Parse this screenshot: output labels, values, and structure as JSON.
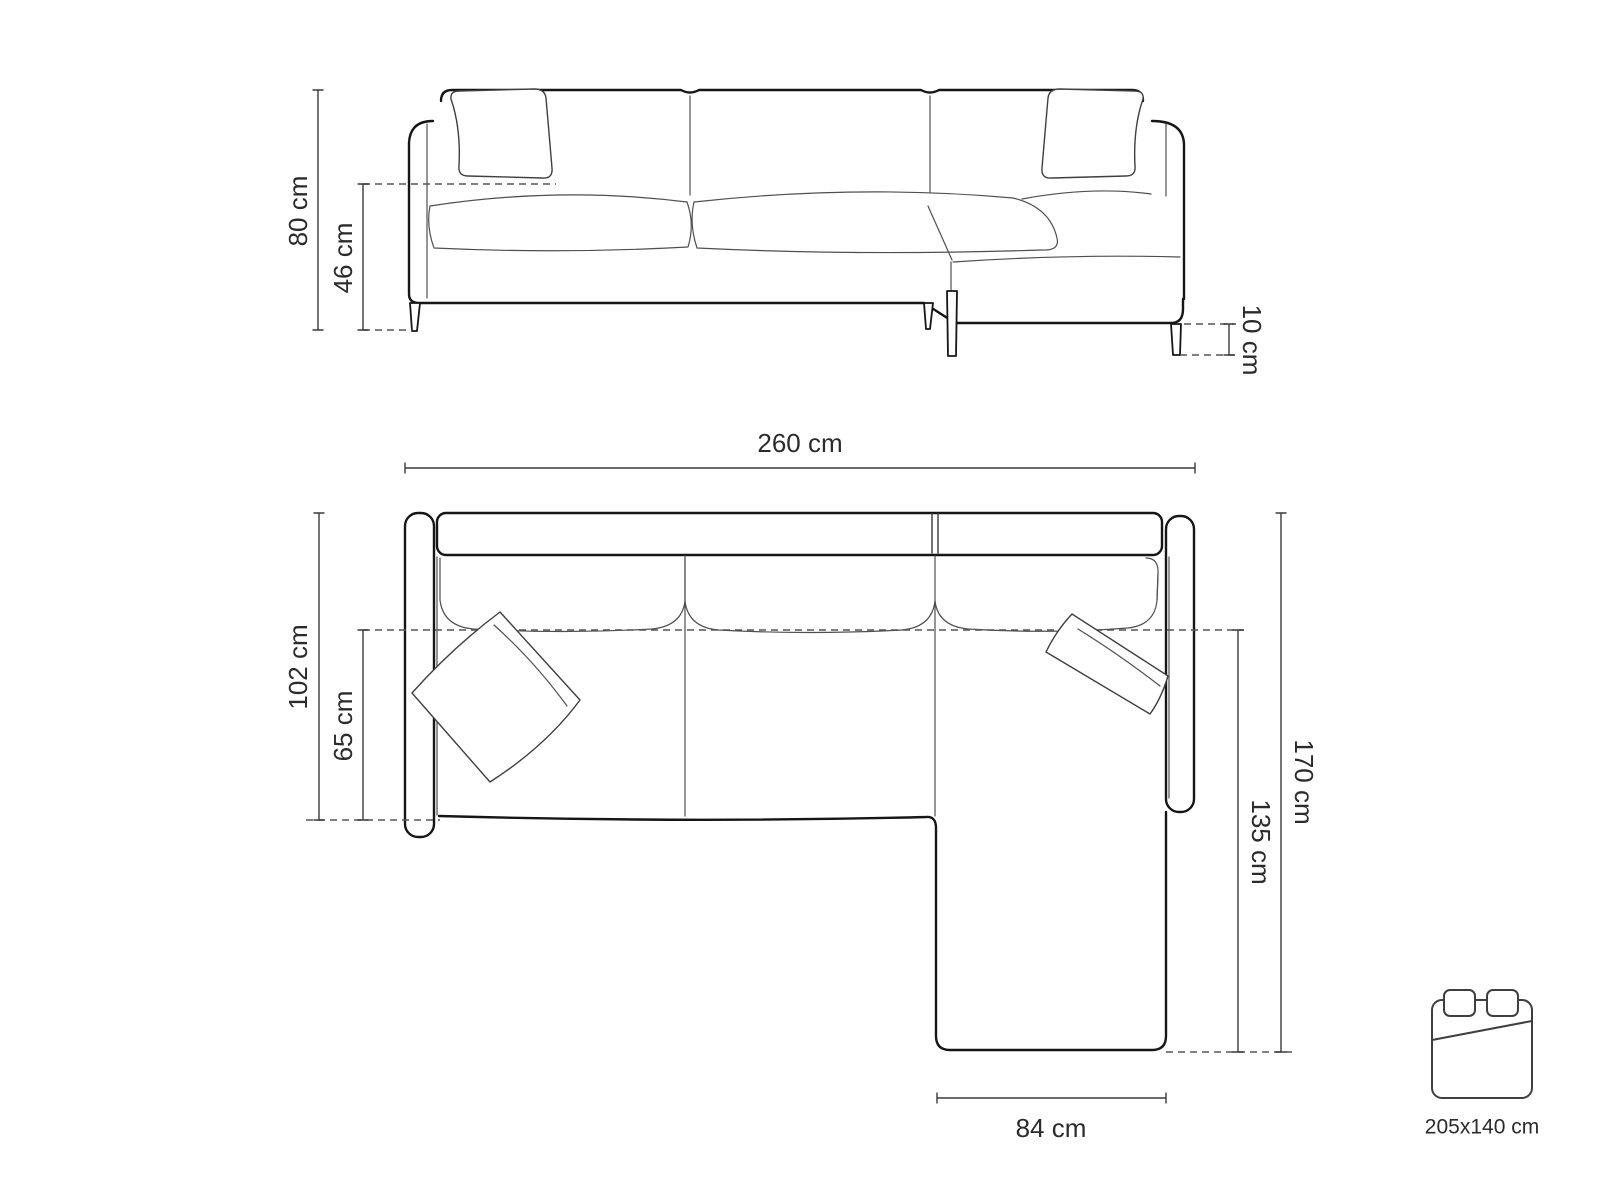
{
  "colors": {
    "background": "#ffffff",
    "outline_bold": "#161616",
    "outline_thin": "#4f4f4f",
    "dimension_line": "#3a3a3a",
    "dashed_line": "#555555",
    "text": "#2b2b2b"
  },
  "front_view": {
    "dimensions": {
      "total_height": "80 cm",
      "seat_height": "46 cm",
      "leg_height": "10 cm"
    }
  },
  "top_view": {
    "dimensions": {
      "total_width": "260 cm",
      "total_depth": "102 cm",
      "seat_depth": "65 cm",
      "total_length": "170 cm",
      "chaise_length": "135 cm",
      "chaise_width": "84 cm"
    }
  },
  "sleeping_area": {
    "icon": "double-bed-icon",
    "label": "205x140 cm"
  }
}
